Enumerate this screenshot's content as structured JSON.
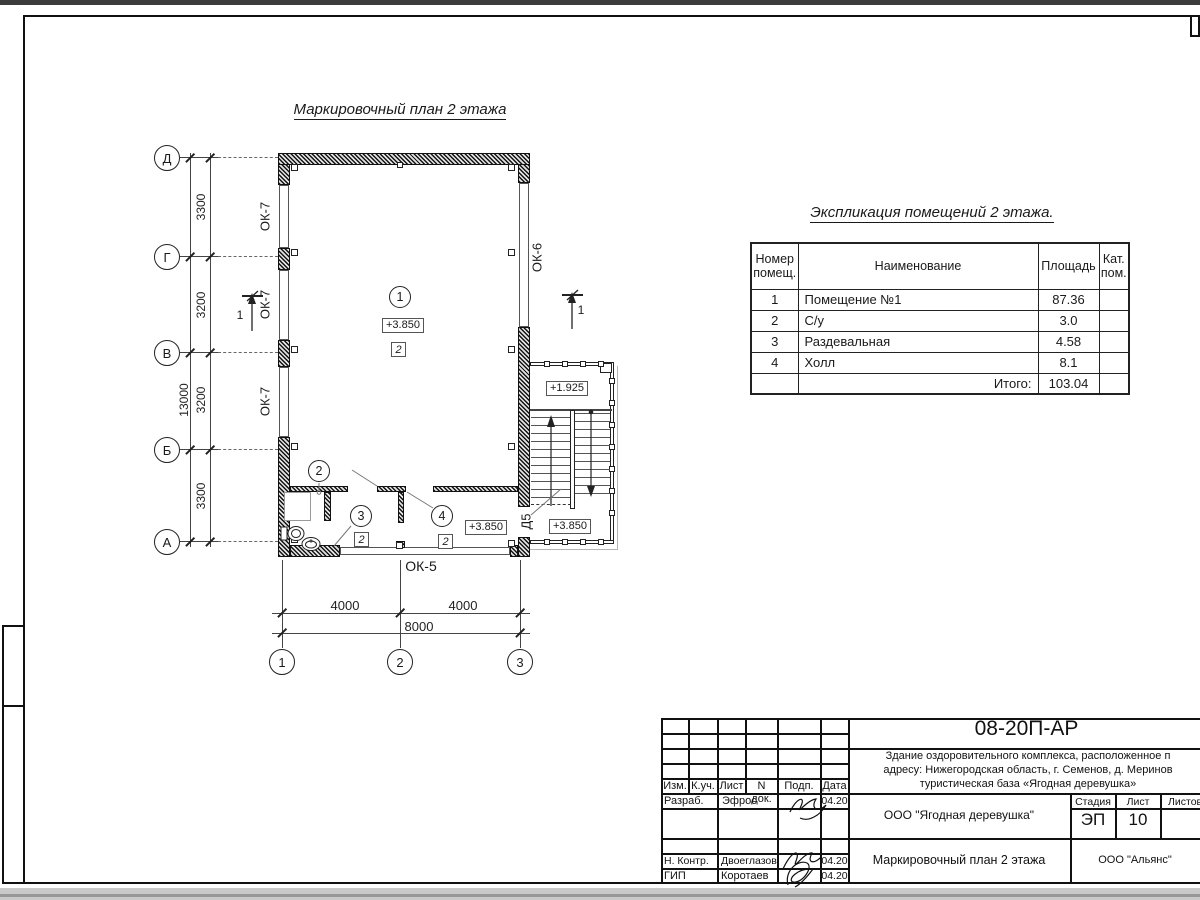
{
  "sheet": {
    "plan_title": "Маркировочный план 2 этажа",
    "axes_vertical": [
      "Д",
      "Г",
      "В",
      "Б",
      "А"
    ],
    "axes_horizontal": [
      "1",
      "2",
      "3"
    ],
    "dims_vertical": [
      "3300",
      "3200",
      "3200",
      "3300"
    ],
    "dim_vertical_total": "13000",
    "dims_horizontal": [
      "4000",
      "4000"
    ],
    "dim_horizontal_total": "8000",
    "marks": {
      "window_left": "ОК-7",
      "window_right": "ОК-6",
      "window_bottom": "ОК-5",
      "door": "Д5",
      "section": "1",
      "type_mark": "2"
    },
    "rooms": [
      "1",
      "2",
      "3",
      "4"
    ],
    "elevations": {
      "main": "+3.850",
      "landing": "+1.925"
    }
  },
  "explication": {
    "title": "Экспликация помещений 2 этажа.",
    "headers": [
      "Номер помещ.",
      "Наименование",
      "Площадь",
      "Кат. пом."
    ],
    "rows": [
      {
        "num": "1",
        "name": "Помещение №1",
        "area": "87.36",
        "cat": ""
      },
      {
        "num": "2",
        "name": "С/у",
        "area": "3.0",
        "cat": ""
      },
      {
        "num": "3",
        "name": "Раздевальная",
        "area": "4.58",
        "cat": ""
      },
      {
        "num": "4",
        "name": "Холл",
        "area": "8.1",
        "cat": ""
      }
    ],
    "total_label": "Итого:",
    "total_value": "103.04"
  },
  "titleblock": {
    "doc_number": "08-20П-АР",
    "description": [
      "Здание оздоровительного комплекса, расположенное п",
      "адресу: Нижегородская область, г. Семенов, д. Меринов",
      "туристическая база «Ягодная деревушка»"
    ],
    "columns": [
      "Изм.",
      "К.уч.",
      "Лист",
      "N док.",
      "Подп.",
      "Дата"
    ],
    "staff": [
      {
        "role": "Разраб.",
        "name": "Эфрос",
        "date": "04.20"
      },
      {
        "role": "Н. Контр.",
        "name": "Двоеглазов",
        "date": "04.20"
      },
      {
        "role": "ГИП",
        "name": "Коротаев",
        "date": "04.20"
      }
    ],
    "client": "ООО \"Ягодная деревушка\"",
    "stage_label": "Стадия",
    "stage": "ЭП",
    "sheet_label": "Лист",
    "sheet_number": "10",
    "sheets_label": "Листов",
    "drawing_title": "Маркировочный план 2 этажа",
    "contractor": "ООО \"Альянс\""
  }
}
